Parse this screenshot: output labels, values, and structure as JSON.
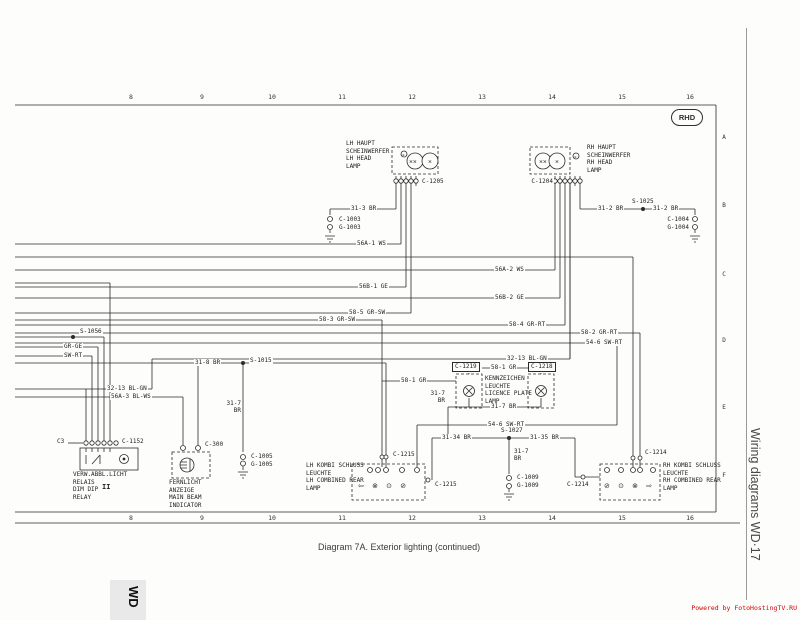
{
  "page": {
    "caption": "Diagram 7A. Exterior lighting (continued)",
    "sidebar_title": "Wiring diagrams WD·17",
    "corner_tab": "WD",
    "watermark": "Powered by FotoHostingTV.RU",
    "badge": "RHD"
  },
  "ruler": {
    "top": [
      "8",
      "9",
      "10",
      "11",
      "12",
      "13",
      "14",
      "15",
      "16"
    ],
    "bottom": [
      "8",
      "9",
      "10",
      "11",
      "12",
      "13",
      "14",
      "15",
      "16"
    ],
    "rows": [
      "A",
      "B",
      "C",
      "D",
      "E",
      "F"
    ]
  },
  "components": {
    "lh_headlamp": {
      "label": "LH HAUPT\nSCHEINWERFER\nLH HEAD\nLAMP",
      "connector": "C-1205"
    },
    "rh_headlamp": {
      "label": "RH HAUPT\nSCHEINWERFER\nRH HEAD\nLAMP",
      "connector": "C-1204"
    },
    "dim_dip_relay": {
      "label": "VERW.ABBL.LICHT\nRELAIS\nDIM DIP\nRELAY",
      "connector": "C-1152",
      "pin_note": "C3",
      "mark": "II"
    },
    "main_beam_indicator": {
      "label": "FERNLICHT\nANZEIGE\nMAIN BEAM\nINDICATOR",
      "connector": "C-300"
    },
    "licence_plate_lamp": {
      "label": "KENNZEICHEN\nLEUCHTE\nLICENCE PLATE\nLAMP",
      "connector_left": "C-1219",
      "connector_right": "C-1218"
    },
    "lh_rear_lamp": {
      "label": "LH KOMBI SCHLUSS\nLEUCHTE\nLH COMBINED REAR\nLAMP",
      "connector_top": "C-1215",
      "connector_side": "C-1215"
    },
    "rh_rear_lamp": {
      "label": "RH KOMBI SCHLUSS\nLEUCHTE\nRH COMBINED REAR\nLAMP",
      "connector_top": "C-1214",
      "connector_side": "C-1214"
    }
  },
  "wire_labels": {
    "w31_3": "31-3 BR",
    "c1003": "C-1003",
    "g1003": "G-1003",
    "w31_2a": "31-2 BR",
    "s1025": "S-1025",
    "w31_2b": "31-2 BR",
    "c1004": "C-1004",
    "g1004": "G-1004",
    "w56a1": "56A-1 WS",
    "w56a2": "56A-2 WS",
    "w56b1": "56B-1 GE",
    "w56b2": "56B-2 GE",
    "w58_5": "58-5 GR-SW",
    "w58_3": "58-3 GR-SW",
    "w58_4": "58-4 GR-RT",
    "w58_2": "58-2 GR-RT",
    "s1056": "S-1056",
    "gr_ge": "GR-GE",
    "sw_rt": "SW-RT",
    "w31_8": "31-8 BR",
    "s1015": "S-1015",
    "w31_7a": "31-7\nBR",
    "c1005": "C-1005",
    "g1005": "G-1005",
    "w32_13l": "32-13 BL-GN",
    "w32_13r": "32-13 BL-GN",
    "w56a3": "56A-3 BL-WS",
    "w58_1l": "58-1 GR",
    "w58_1t": "58-1 GR",
    "w31_7b": "31-7 BR",
    "w31_7c": "31-7\nBR",
    "w54_6a": "54-6 SW-RT",
    "w54_6b": "54-6 SW-RT",
    "w31_34": "31-34 BR",
    "s1027": "S-1027",
    "w31_35": "31-35 BR",
    "w31_7d": "31-7\nBR",
    "c1009": "C-1009",
    "g1009": "G-1009"
  },
  "icons": {
    "lh_rear_symbols": "⇦ ⊗ ⊙ ⊘",
    "rh_rear_symbols": "⊘ ⊙ ⊗ ⇨",
    "filament_double": "××",
    "filament_single": "×"
  }
}
